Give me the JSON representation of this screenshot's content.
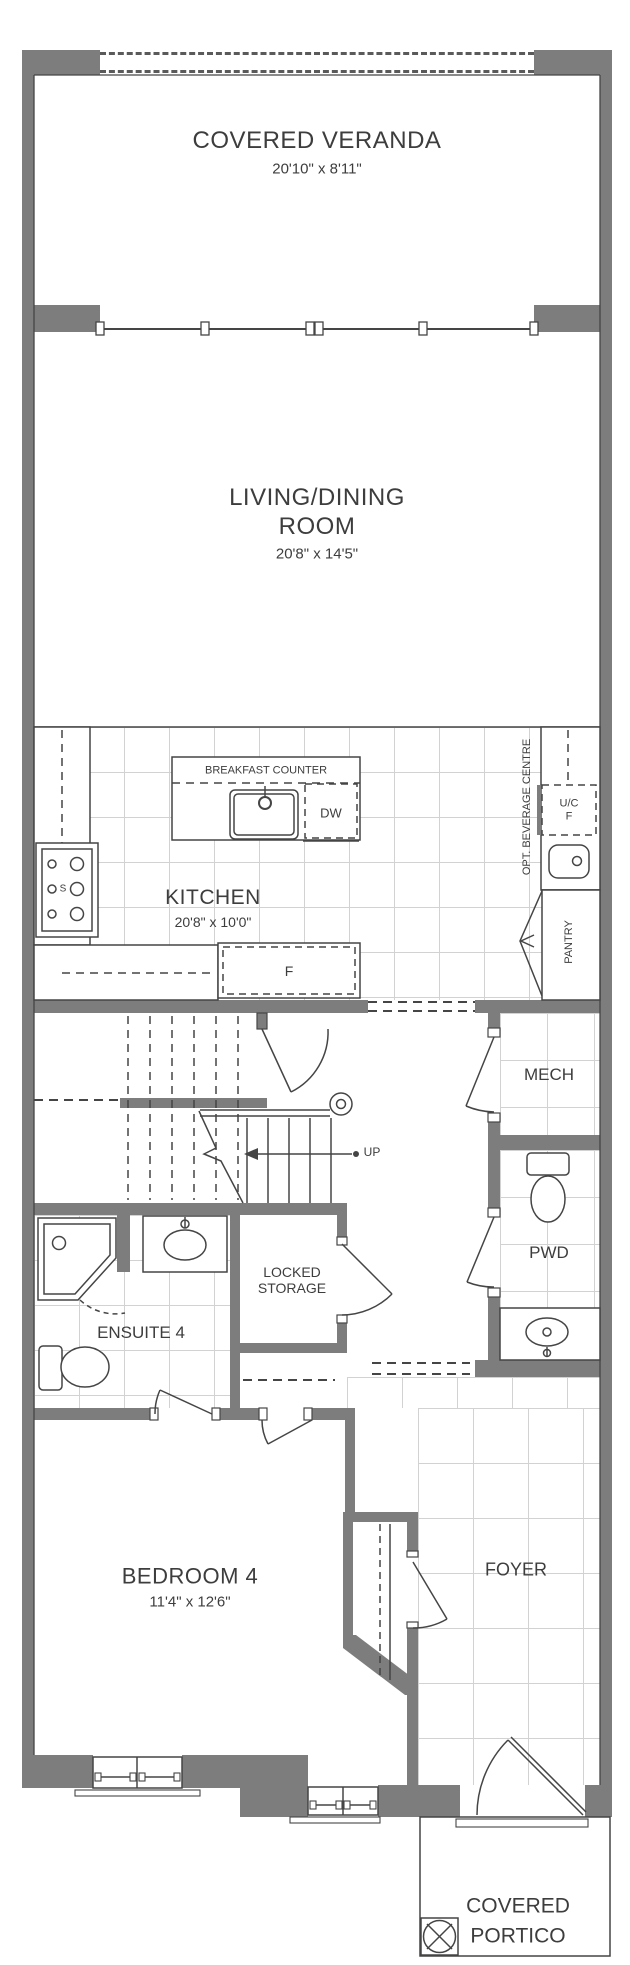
{
  "plan_title": "Ground Floor Plan",
  "rooms": {
    "veranda": {
      "name": "COVERED VERANDA",
      "dims": "20'10\" x 8'11\""
    },
    "living": {
      "name": "LIVING/DINING",
      "name2": "ROOM",
      "dims": "20'8\" x 14'5\""
    },
    "kitchen": {
      "name": "KITCHEN",
      "dims": "20'8\" x 10'0\""
    },
    "mech": {
      "name": "MECH"
    },
    "pwd": {
      "name": "PWD"
    },
    "ensuite": {
      "name": "ENSUITE 4"
    },
    "storage": {
      "name1": "LOCKED",
      "name2": "STORAGE"
    },
    "bedroom": {
      "name": "BEDROOM 4",
      "dims": "11'4\" x 12'6\""
    },
    "foyer": {
      "name": "FOYER"
    },
    "portico": {
      "name1": "COVERED",
      "name2": "PORTICO"
    }
  },
  "fixtures": {
    "breakfast_counter": "BREAKFAST COUNTER",
    "dishwasher": "DW",
    "fridge": "F",
    "uc_fridge_line1": "U/C",
    "uc_fridge_line2": "F",
    "beverage_centre": "OPT. BEVERAGE CENTRE",
    "pantry": "PANTRY",
    "stove": "S",
    "stair_direction": "UP"
  },
  "colors": {
    "wall_gray": "#7d7d7d",
    "line_dark": "#454545",
    "tile_gray": "#d2d2d2",
    "text_gray": "#3d3d3d"
  }
}
